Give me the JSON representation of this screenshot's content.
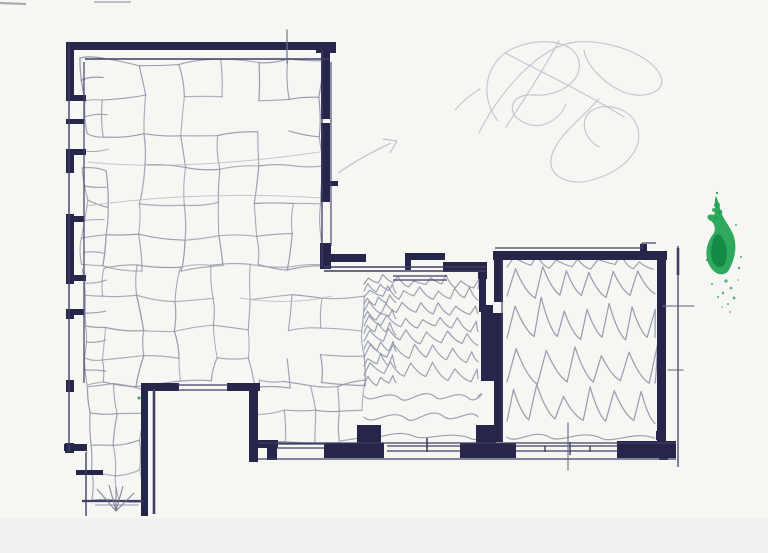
{
  "scene": {
    "kind": "scanned hand-drawn architectural floor plan sketch, ink walls with pencil floor textures and a green ink stain",
    "colors": {
      "paper": "#f6f6f3",
      "paper_strip": "#e9ecee",
      "edge_mark": "#949aa4",
      "ink": "#26264a",
      "ink_soft": "#3f3f66",
      "pencil": "#8f96a8",
      "pencil_light": "#bdc2cb",
      "pencil_dark": "#6e7589",
      "guide": "#b5bac4",
      "green": "#23a455",
      "green_dark": "#108442"
    }
  },
  "plan": {
    "bold_rects": [
      [
        66,
        42,
        270,
        8
      ],
      [
        316,
        42,
        20,
        11
      ],
      [
        66,
        42,
        8,
        58
      ],
      [
        66,
        149,
        8,
        24
      ],
      [
        66,
        214,
        8,
        70
      ],
      [
        66,
        309,
        8,
        10
      ],
      [
        66,
        380,
        8,
        12
      ],
      [
        65,
        443,
        9,
        10
      ],
      [
        66,
        95,
        20,
        6
      ],
      [
        66,
        119,
        18,
        5
      ],
      [
        66,
        149,
        20,
        6
      ],
      [
        66,
        216,
        18,
        6
      ],
      [
        66,
        275,
        20,
        6
      ],
      [
        66,
        309,
        18,
        6
      ],
      [
        64,
        444,
        23,
        7
      ],
      [
        76,
        470,
        27,
        5
      ],
      [
        321,
        49,
        9,
        70
      ],
      [
        321,
        123,
        9,
        79
      ],
      [
        330,
        181,
        8,
        5
      ],
      [
        320,
        243,
        11,
        26
      ],
      [
        323,
        254,
        43,
        8
      ],
      [
        405,
        253,
        6,
        17
      ],
      [
        405,
        253,
        40,
        7
      ],
      [
        443,
        262,
        44,
        10
      ],
      [
        478,
        263,
        9,
        16
      ],
      [
        479,
        276,
        7,
        36
      ],
      [
        481,
        305,
        16,
        76
      ],
      [
        493,
        251,
        174,
        9
      ],
      [
        640,
        244,
        7,
        9
      ],
      [
        494,
        259,
        9,
        183
      ],
      [
        657,
        251,
        9,
        191
      ],
      [
        656,
        431,
        9,
        9
      ],
      [
        141,
        383,
        38,
        8
      ],
      [
        227,
        383,
        33,
        8
      ],
      [
        141,
        383,
        7,
        133
      ],
      [
        249,
        383,
        9,
        79
      ],
      [
        249,
        440,
        29,
        8
      ],
      [
        267,
        440,
        10,
        20
      ],
      [
        324,
        443,
        60,
        15
      ],
      [
        357,
        425,
        24,
        20
      ],
      [
        460,
        443,
        56,
        15
      ],
      [
        476,
        425,
        20,
        20
      ],
      [
        617,
        441,
        59,
        17
      ],
      [
        659,
        441,
        9,
        19
      ]
    ],
    "clear_rects": [
      [
        493,
        302,
        11,
        11
      ]
    ],
    "thin_lines": [
      [
        85,
        59,
        329,
        59,
        1.5
      ],
      [
        69,
        43,
        69,
        452,
        1.4
      ],
      [
        84,
        62,
        84,
        383,
        1.2
      ],
      [
        86,
        452,
        86,
        516,
        1.4
      ],
      [
        322,
        50,
        322,
        267,
        1.3
      ],
      [
        331,
        62,
        331,
        246,
        1.1
      ],
      [
        324,
        267,
        486,
        267,
        1.4
      ],
      [
        324,
        271,
        486,
        271,
        1.4
      ],
      [
        393,
        276,
        447,
        276,
        1.2
      ],
      [
        393,
        280,
        447,
        280,
        1.2
      ],
      [
        495,
        248,
        642,
        248,
        1.3
      ],
      [
        642,
        243,
        642,
        249,
        1.2
      ],
      [
        642,
        243,
        656,
        243,
        1.2
      ],
      [
        502,
        260,
        502,
        439,
        1.2
      ],
      [
        678,
        246,
        678,
        467,
        1.3
      ],
      [
        678,
        248,
        678,
        275,
        2.6
      ],
      [
        258,
        443,
        676,
        443,
        1.2
      ],
      [
        258,
        459,
        676,
        459,
        1.3
      ],
      [
        177,
        385,
        228,
        385,
        1.3
      ],
      [
        177,
        390,
        228,
        390,
        1.3
      ],
      [
        277,
        444,
        325,
        444,
        1.3
      ],
      [
        277,
        448,
        325,
        448,
        1.3
      ],
      [
        387,
        446,
        461,
        446,
        1.3
      ],
      [
        387,
        451,
        461,
        451,
        1.3
      ],
      [
        515,
        446,
        618,
        446,
        1.3
      ],
      [
        515,
        451,
        618,
        451,
        1.3
      ],
      [
        154,
        389,
        154,
        514,
        2.6
      ],
      [
        82,
        501,
        143,
        501,
        2.2
      ],
      [
        427,
        438,
        427,
        452,
        1.6
      ],
      [
        545,
        446,
        545,
        452,
        1.4
      ],
      [
        570,
        442,
        570,
        455,
        1.4
      ],
      [
        590,
        446,
        590,
        452,
        1.4
      ]
    ],
    "pencil_ticks": [
      [
        287,
        30,
        287,
        63
      ],
      [
        663,
        306,
        694,
        306
      ],
      [
        668,
        370,
        683,
        370
      ],
      [
        568,
        423,
        568,
        470
      ]
    ],
    "fan_mark": {
      "center": [
        116,
        511
      ],
      "spokes": [
        [
          97,
          489
        ],
        [
          109,
          485
        ],
        [
          116,
          487
        ],
        [
          123,
          486
        ],
        [
          134,
          493
        ]
      ],
      "base": [
        95,
        505,
        139,
        505
      ]
    },
    "edge_marks": [
      [
        0,
        3,
        26,
        4,
        2.2
      ],
      [
        94,
        2,
        131,
        2,
        1.4
      ]
    ]
  },
  "textures": {
    "stone_regions": [
      {
        "x": 84,
        "y": 62,
        "cols": [
          22,
          36,
          40,
          38,
          36,
          34,
          32
        ],
        "rows": [
          37,
          35,
          34,
          36,
          33,
          31
        ],
        "small_first_col": true
      },
      {
        "x": 84,
        "y": 268,
        "cols": [
          22,
          34,
          38,
          36,
          38,
          36,
          34,
          42
        ],
        "rows": [
          30,
          30,
          28,
          28
        ],
        "small_first_col": true
      },
      {
        "x": 90,
        "y": 386,
        "cols": [
          26,
          26
        ],
        "rows": [
          28,
          30,
          28,
          26
        ],
        "small_first_col": false
      },
      {
        "x": 258,
        "y": 384,
        "cols": [
          28,
          26,
          26,
          26
        ],
        "rows": [
          28,
          28
        ],
        "small_first_col": false
      }
    ],
    "stone_guides": [
      "M 88 162 Q 180 172 320 152",
      "M 86 206 Q 200 190 322 198",
      "M 240 298 Q 290 306 332 296"
    ],
    "wave_rows": [
      {
        "x1": 364,
        "x2": 478,
        "y": 284,
        "amp": 8,
        "wl": 16,
        "sharp": true,
        "drift": 4
      },
      {
        "x1": 364,
        "x2": 478,
        "y": 297,
        "amp": 9,
        "wl": 17,
        "sharp": true,
        "drift": 4
      },
      {
        "x1": 364,
        "x2": 478,
        "y": 311,
        "amp": 10,
        "wl": 18,
        "sharp": true,
        "drift": 5
      },
      {
        "x1": 364,
        "x2": 478,
        "y": 326,
        "amp": 10,
        "wl": 19,
        "sharp": true,
        "drift": 5
      },
      {
        "x1": 364,
        "x2": 478,
        "y": 341,
        "amp": 11,
        "wl": 20,
        "sharp": true,
        "drift": 5
      },
      {
        "x1": 364,
        "x2": 478,
        "y": 357,
        "amp": 12,
        "wl": 21,
        "sharp": true,
        "drift": 6
      },
      {
        "x1": 364,
        "x2": 478,
        "y": 375,
        "amp": 12,
        "wl": 22,
        "sharp": true,
        "drift": 6
      },
      {
        "x1": 364,
        "x2": 478,
        "y": 396,
        "amp": 9,
        "wl": 38,
        "sharp": false
      },
      {
        "x1": 364,
        "x2": 478,
        "y": 417,
        "amp": 10,
        "wl": 46,
        "sharp": false
      },
      {
        "x1": 364,
        "x2": 478,
        "y": 436,
        "amp": 7,
        "wl": 52,
        "sharp": false
      },
      {
        "x1": 364,
        "x2": 396,
        "y": 291,
        "amp": 7,
        "wl": 11,
        "sharp": true
      },
      {
        "x1": 364,
        "x2": 396,
        "y": 304,
        "amp": 7,
        "wl": 11,
        "sharp": true
      },
      {
        "x1": 364,
        "x2": 396,
        "y": 318,
        "amp": 8,
        "wl": 12,
        "sharp": true
      },
      {
        "x1": 364,
        "x2": 396,
        "y": 333,
        "amp": 8,
        "wl": 12,
        "sharp": true
      },
      {
        "x1": 364,
        "x2": 396,
        "y": 349,
        "amp": 8,
        "wl": 12,
        "sharp": true
      },
      {
        "x1": 364,
        "x2": 396,
        "y": 366,
        "amp": 9,
        "wl": 13,
        "sharp": true
      },
      {
        "x1": 364,
        "x2": 396,
        "y": 385,
        "amp": 9,
        "wl": 13,
        "sharp": true
      }
    ],
    "zigzag_rows": [
      {
        "x1": 507,
        "x2": 655,
        "y": 267,
        "amp": 9,
        "wl": 22,
        "sharp": true
      },
      {
        "x1": 507,
        "x2": 655,
        "y": 296,
        "amp": 30,
        "wl": 25,
        "sharp": true,
        "w": 1.25
      },
      {
        "x1": 507,
        "x2": 655,
        "y": 338,
        "amp": 33,
        "wl": 26,
        "sharp": true,
        "w": 1.25
      },
      {
        "x1": 507,
        "x2": 655,
        "y": 382,
        "amp": 35,
        "wl": 27,
        "sharp": true,
        "w": 1.25
      },
      {
        "x1": 507,
        "x2": 655,
        "y": 421,
        "amp": 30,
        "wl": 26,
        "sharp": true,
        "w": 1.25
      },
      {
        "x1": 507,
        "x2": 655,
        "y": 437,
        "amp": 8,
        "wl": 50,
        "sharp": false
      }
    ]
  },
  "marks": {
    "scribbles": [
      "M 498 121 C 478 96 486 60 514 48 C 540 37 574 40 579 61 C 583 81 559 97 534 95 C 512 93 505 111 521 121 C 540 133 561 119 566 104",
      "M 479 133 C 499 92 539 46 576 42 C 612 39 654 57 661 77 C 667 94 639 100 621 91 C 600 81 586 63 584 50",
      "M 505 53 C 540 71 589 95 624 117",
      "M 559 41 C 541 74 521 104 506 127",
      "M 599 99 C 581 119 553 139 551 160 C 549 178 571 186 592 180 C 622 172 643 151 638 129 C 633 108 605 101 591 111 C 579 120 584 139 599 147",
      "M 455 110 C 463 101 471 94 480 89"
    ],
    "arrow_shaft": "M 338 173 C 354 162 374 151 391 143",
    "arrow_head": "M 383 139 L 397 141 L 390 153",
    "stain_main": "M 716 196 C 713 203 717 208 714 215 C 707 213 705 218 711 221 C 714 223 716 228 714 233 C 705 244 704 258 711 268 C 717 276 726 277 730 268 C 736 256 737 244 733 234 C 729 225 724 220 721 212 C 719 205 718 200 716 196 Z",
    "stain_dark": "M 714 238 C 710 247 710 258 714 264 C 718 269 724 268 726 261 C 728 252 726 243 722 237 C 719 233 716 234 714 238 Z",
    "stain_blobs": [
      [
        717,
        205,
        3
      ],
      [
        714,
        210,
        2
      ],
      [
        720,
        212,
        2.4
      ],
      [
        716,
        218,
        2
      ],
      [
        717,
        193,
        1.2
      ]
    ],
    "stain_speckles": [
      [
        726,
        281,
        1.6
      ],
      [
        731,
        288,
        1.3
      ],
      [
        723,
        293,
        1.2
      ],
      [
        734,
        298,
        1.4
      ],
      [
        728,
        304,
        1.0
      ],
      [
        739,
        268,
        1.2
      ],
      [
        741,
        257,
        1.0
      ],
      [
        712,
        284,
        1.0
      ],
      [
        718,
        297,
        1.0
      ],
      [
        707,
        260,
        1.2
      ],
      [
        736,
        225,
        1.0
      ],
      [
        722,
        307,
        0.8
      ],
      [
        730,
        312,
        0.9
      ],
      [
        738,
        280,
        0.8
      ]
    ],
    "green_dot": [
      139,
      398,
      1.5
    ]
  }
}
